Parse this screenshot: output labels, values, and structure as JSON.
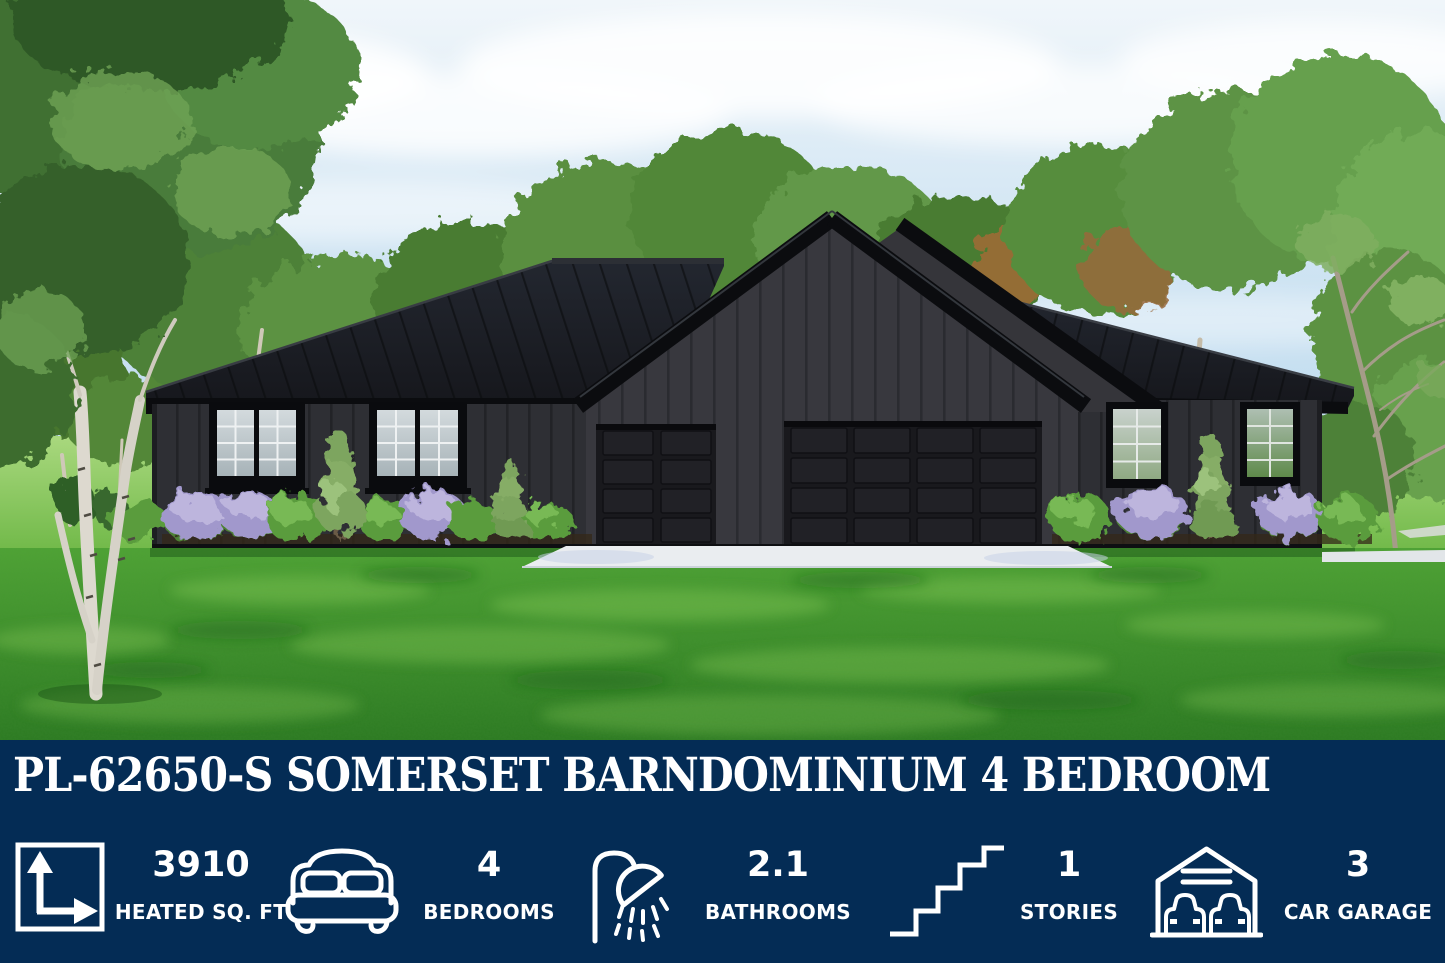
{
  "banner": {
    "title": "PL-62650-S SOMERSET BARNDOMINIUM 4 BEDROOM",
    "colors": {
      "background": "#042c55",
      "text": "#ffffff"
    },
    "stats": [
      {
        "icon": "floor-area-icon",
        "value": "3910",
        "label": "HEATED SQ. FT"
      },
      {
        "icon": "bed-icon",
        "value": "4",
        "label": "BEDROOMS"
      },
      {
        "icon": "shower-icon",
        "value": "2.1",
        "label": "BATHROOMS"
      },
      {
        "icon": "stairs-icon",
        "value": "1",
        "label": "STORIES"
      },
      {
        "icon": "garage-icon",
        "value": "3",
        "label": "CAR GARAGE"
      }
    ]
  },
  "scene": {
    "colors": {
      "sky": "#cde3f3",
      "lawn": "#43982f",
      "siding": "#323237",
      "roof": "#1b1d22",
      "driveway": "#e9ecef"
    }
  }
}
